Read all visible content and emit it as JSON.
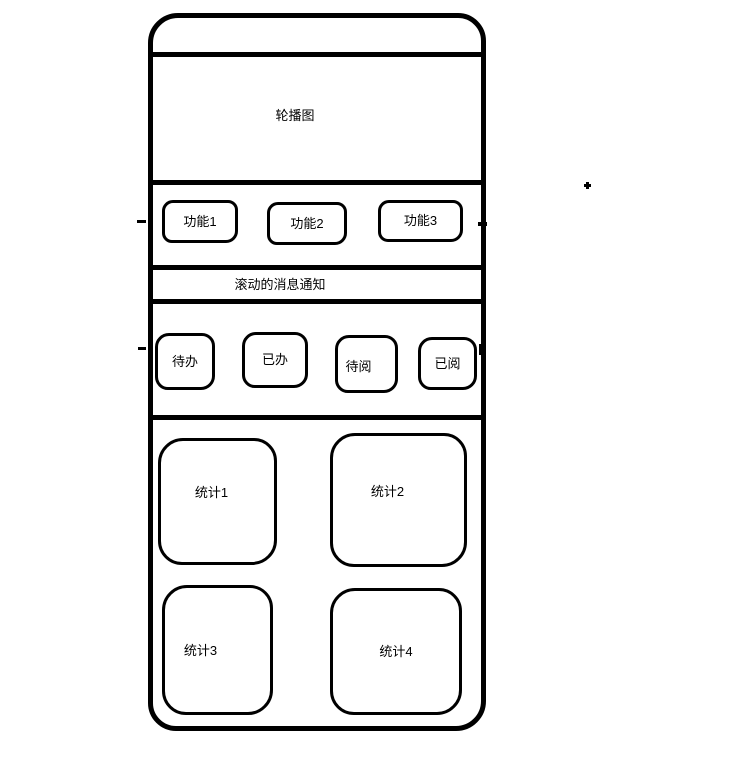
{
  "colors": {
    "stroke": "#000000",
    "fill": "#ffffff",
    "page_background": "#ffffff"
  },
  "phone": {
    "carousel": {
      "label": "轮播图"
    },
    "function_buttons": [
      {
        "label": "功能1"
      },
      {
        "label": "功能2"
      },
      {
        "label": "功能3"
      }
    ],
    "notice_bar": {
      "label": "滚动的消息通知"
    },
    "action_buttons": [
      {
        "label": "待办"
      },
      {
        "label": "已办"
      },
      {
        "label": "待阅"
      },
      {
        "label": "已阅"
      }
    ],
    "stat_cards": [
      {
        "label": "统计1"
      },
      {
        "label": "统计2"
      },
      {
        "label": "统计3"
      },
      {
        "label": "统计4"
      }
    ]
  }
}
